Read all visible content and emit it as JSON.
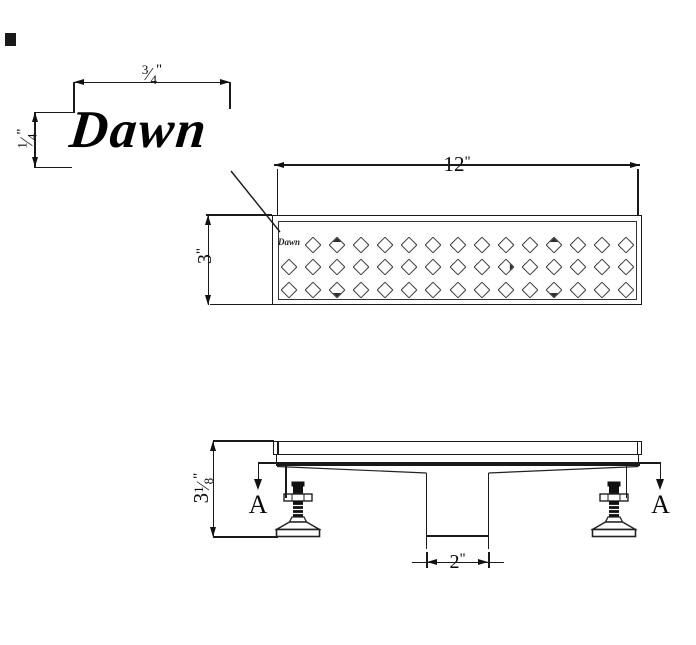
{
  "drawing": {
    "brand_logo": "Dawn",
    "grate_logo": "Dawn",
    "section_label": "A"
  },
  "dimensions": {
    "logo_offset_width": {
      "numerator": "3",
      "denominator": "4",
      "unit": "\""
    },
    "logo_offset_height": {
      "numerator": "1",
      "denominator": "4",
      "unit": "\""
    },
    "grate_length": {
      "value": "12",
      "unit": "\""
    },
    "grate_width": {
      "value": "3",
      "unit": "\""
    },
    "overall_height": {
      "whole": "3",
      "numerator": "1",
      "denominator": "8",
      "unit": "\""
    },
    "outlet_width": {
      "value": "2",
      "unit": "\""
    }
  },
  "grate": {
    "rows": 3,
    "cols": 15,
    "logo_cell": {
      "row": 0,
      "col": 0
    },
    "smudged_cells": [
      {
        "row": 0,
        "col": 2,
        "corner": "top"
      },
      {
        "row": 0,
        "col": 11,
        "corner": "top"
      },
      {
        "row": 2,
        "col": 2,
        "corner": "bottom"
      },
      {
        "row": 2,
        "col": 11,
        "corner": "bottom"
      },
      {
        "row": 1,
        "col": 9,
        "corner": "right"
      }
    ]
  },
  "colors": {
    "line": "#1a1a1a",
    "background": "#ffffff"
  }
}
